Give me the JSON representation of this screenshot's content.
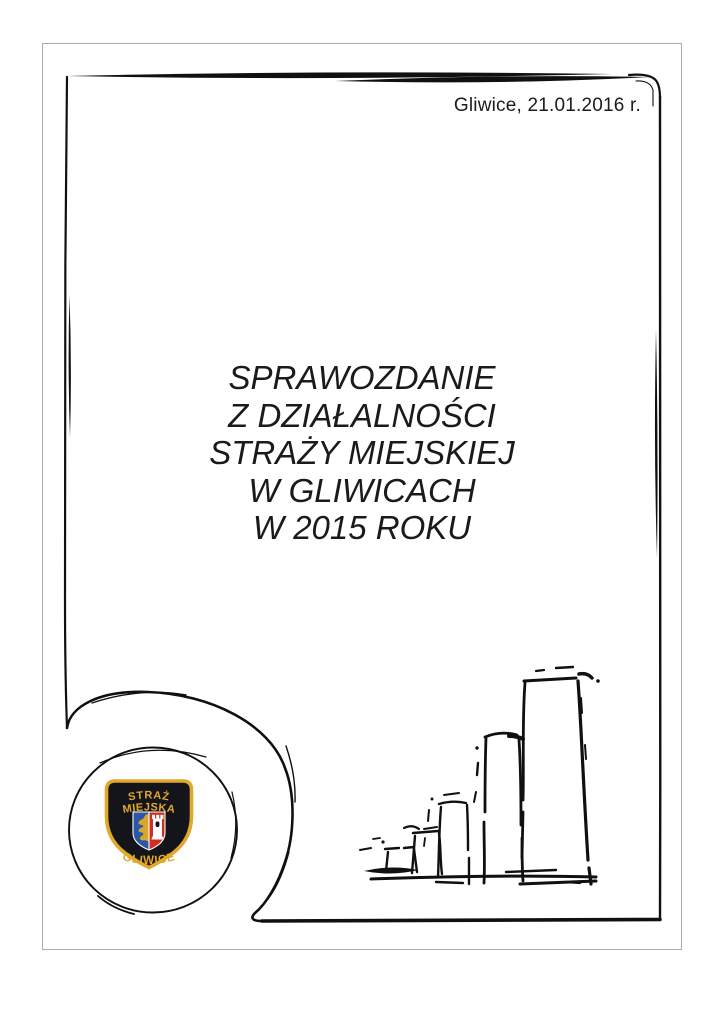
{
  "page": {
    "date_line": "Gliwice, 21.01.2016 r.",
    "title_lines": [
      "SPRAWOZDANIE",
      "Z DZIAŁALNOŚCI",
      "STRAŻY MIEJSKIEJ",
      "W GLIWICACH",
      "W 2015 ROKU"
    ]
  },
  "badge": {
    "top_line": "STRAŻ",
    "second_line": "MIEJSKA",
    "bottom_line": "GLIWICE"
  },
  "icons": {
    "frame": "hand-drawn-ink-frame",
    "badge": "straz-miejska-gliwice-patch",
    "sketch": "ascending-bar-chart-sketch"
  },
  "colors": {
    "ink": "#101010",
    "page_border": "#ababab",
    "badge_background": "#14141b",
    "badge_gold": "#e2a829",
    "badge_blue": "#2b57a6",
    "badge_red": "#cf2e27",
    "badge_tower": "#ffffff"
  }
}
